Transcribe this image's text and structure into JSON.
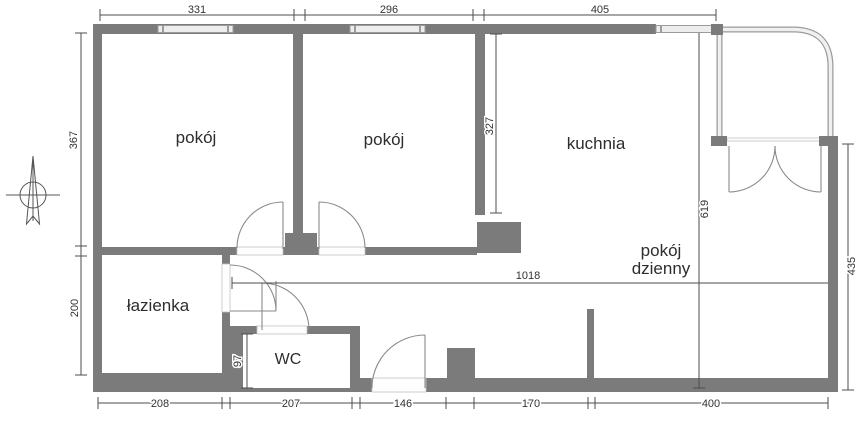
{
  "rooms": {
    "room_top_left": "pokój",
    "room_top_middle": "pokój",
    "kitchen": "kuchnia",
    "living_line1": "pokój",
    "living_line2": "dzienny",
    "bathroom": "łazienka",
    "wc": "WC"
  },
  "dimensions": {
    "top": [
      "331",
      "296",
      "405"
    ],
    "left": [
      "367",
      "200"
    ],
    "bottom": [
      "208",
      "207",
      "146",
      "170",
      "400"
    ],
    "right": [
      "435"
    ],
    "interior": {
      "hall": "1018",
      "living": "619",
      "kitchen": "327",
      "wc": "97"
    }
  },
  "icons": {
    "compass": "north-arrow-icon"
  },
  "colors": {
    "wall": "#7b7b7b",
    "dimension_line": "#4c4c4c",
    "text": "#2d2d2d",
    "window_fill": "#ededed",
    "background": "#ffffff"
  }
}
